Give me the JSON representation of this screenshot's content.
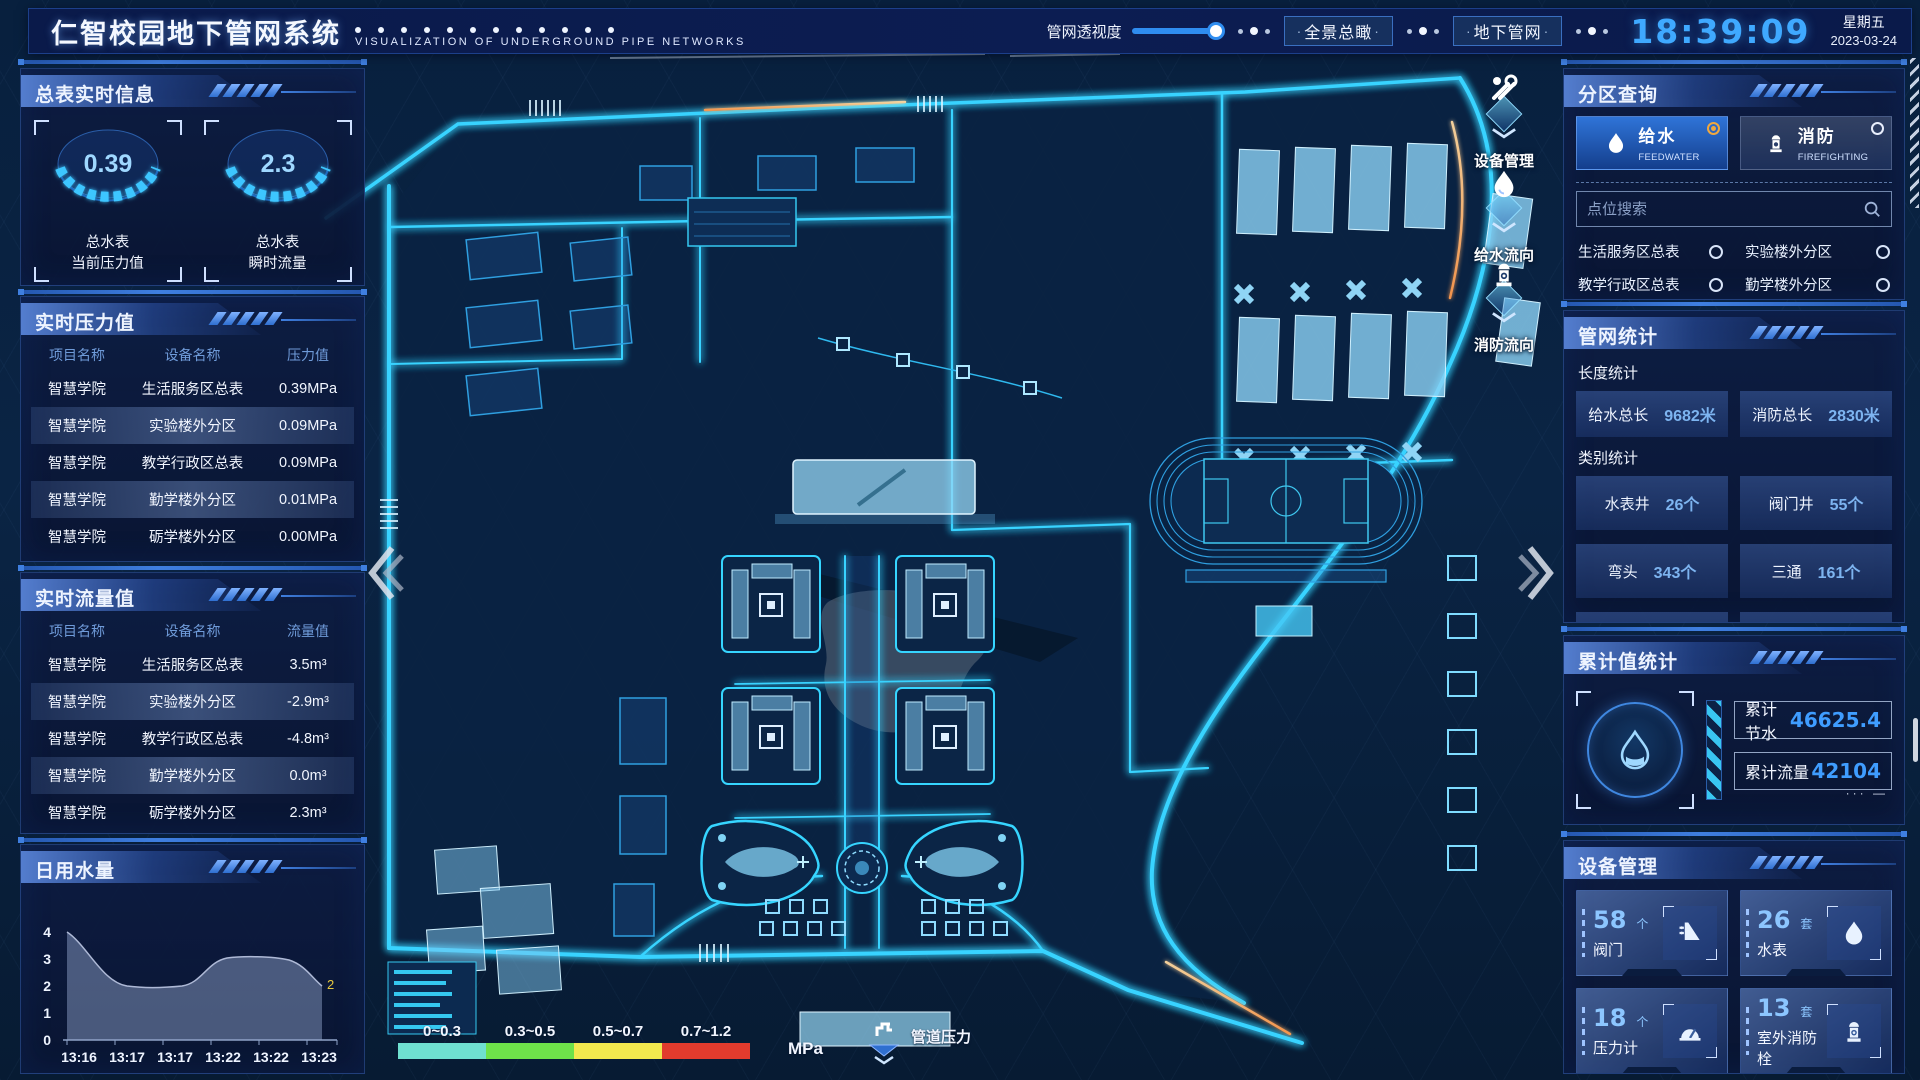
{
  "header": {
    "title": "仁智校园地下管网系统",
    "subtitle": "VISUALIZATION OF UNDERGROUND PIPE NETWORKS",
    "slider_label": "管网透视度",
    "slider_fill": "92%",
    "buttons": [
      {
        "label": "全景总瞰"
      },
      {
        "label": "地下管网"
      }
    ],
    "clock": "18:39:09",
    "weekday": "星期五",
    "date": "2023-03-24"
  },
  "left": {
    "meter_panel": {
      "title": "总表实时信息",
      "gauges": [
        {
          "value": "0.39",
          "line1": "总水表",
          "line2": "当前压力值"
        },
        {
          "value": "2.3",
          "line1": "总水表",
          "line2": "瞬时流量"
        }
      ]
    },
    "pressure_panel": {
      "title": "实时压力值",
      "columns": [
        "项目名称",
        "设备名称",
        "压力值"
      ],
      "rows": [
        [
          "智慧学院",
          "生活服务区总表",
          "0.39MPa"
        ],
        [
          "智慧学院",
          "实验楼外分区",
          "0.09MPa"
        ],
        [
          "智慧学院",
          "教学行政区总表",
          "0.09MPa"
        ],
        [
          "智慧学院",
          "勤学楼外分区",
          "0.01MPa"
        ],
        [
          "智慧学院",
          "砺学楼外分区",
          "0.00MPa"
        ]
      ]
    },
    "flow_panel": {
      "title": "实时流量值",
      "columns": [
        "项目名称",
        "设备名称",
        "流量值"
      ],
      "rows": [
        [
          "智慧学院",
          "生活服务区总表",
          "3.5m³"
        ],
        [
          "智慧学院",
          "实验楼外分区",
          "-2.9m³"
        ],
        [
          "智慧学院",
          "教学行政区总表",
          "-4.8m³"
        ],
        [
          "智慧学院",
          "勤学楼外分区",
          "0.0m³"
        ],
        [
          "智慧学院",
          "砺学楼外分区",
          "2.3m³"
        ]
      ]
    },
    "daily_panel": {
      "title": "日用水量"
    }
  },
  "chart_data": {
    "type": "area",
    "title": "日用水量",
    "x": [
      "13:16",
      "13:17",
      "13:17",
      "13:22",
      "13:22",
      "13:23"
    ],
    "values": [
      4,
      2.1,
      2.1,
      3,
      3,
      2
    ],
    "yticks": [
      "4",
      "3",
      "2",
      "1",
      "0"
    ],
    "ylim": [
      0,
      4
    ],
    "end_label": "2",
    "end_label_color": "#e8c93e",
    "fill_color": "rgba(150,170,210,0.45)",
    "line_color": "#aeb9d6"
  },
  "right": {
    "zone_panel": {
      "title": "分区查询",
      "feedwater": {
        "label": "给水",
        "sub": "FEEDWATER",
        "selected": true
      },
      "firefighting": {
        "label": "消防",
        "sub": "FIREFIGHTING",
        "selected": false
      },
      "search_placeholder": "点位搜索",
      "options": [
        "生活服务区总表",
        "实验楼外分区",
        "教学行政区总表",
        "勤学楼外分区",
        "砺学楼外分区",
        "宿舍区泵房"
      ]
    },
    "network_panel": {
      "title": "管网统计",
      "length_label": "长度统计",
      "length_stats": [
        {
          "name": "给水总长",
          "value": "9682米"
        },
        {
          "name": "消防总长",
          "value": "2830米"
        }
      ],
      "category_label": "类别统计",
      "category_stats": [
        {
          "name": "水表井",
          "value": "26个"
        },
        {
          "name": "阀门井",
          "value": "55个"
        },
        {
          "name": "弯头",
          "value": "343个"
        },
        {
          "name": "三通",
          "value": "161个"
        }
      ]
    },
    "cumulative_panel": {
      "title": "累计值统计",
      "rows": [
        {
          "name": "累计节水",
          "value": "46625.4"
        },
        {
          "name": "累计流量",
          "value": "42104"
        }
      ]
    },
    "device_panel": {
      "title": "设备管理",
      "cards": [
        {
          "count": "58",
          "unit": "个",
          "name": "阀门",
          "icon": "valve-icon"
        },
        {
          "count": "26",
          "unit": "套",
          "name": "水表",
          "icon": "water-meter-icon"
        },
        {
          "count": "18",
          "unit": "个",
          "name": "压力计",
          "icon": "pressure-gauge-icon"
        },
        {
          "count": "13",
          "unit": "套",
          "name": "室外消防栓",
          "icon": "hydrant-icon"
        }
      ]
    }
  },
  "map": {
    "float_tools": [
      {
        "label": "设备管理",
        "icon": "wrench-icon"
      },
      {
        "label": "给水流向",
        "icon": "water-drop-icon"
      },
      {
        "label": "消防流向",
        "icon": "hydrant-icon"
      }
    ],
    "legend": {
      "ranges": [
        "0~0.3",
        "0.3~0.5",
        "0.5~0.7",
        "0.7~1.2"
      ],
      "colors": [
        "#6fe0d0",
        "#6ee24a",
        "#f2e94e",
        "#e23b2d"
      ],
      "unit": "MPa",
      "label": "管道压力"
    }
  },
  "colors": {
    "accent_blue": "#3f9dff",
    "road_cyan": "#37d3ff",
    "value_blue": "#7db4f0",
    "alert_orange": "#f0a83f"
  }
}
